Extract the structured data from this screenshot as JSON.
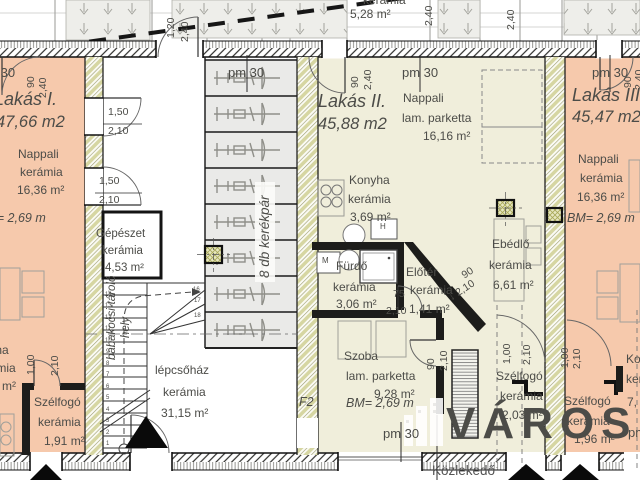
{
  "watermark": {
    "text": "VÁROSI"
  },
  "colors": {
    "apartment_warm": "#f6c9ac",
    "apartment_cool": "#f0eedb",
    "bike_area": "#eaeae8",
    "wall_hatch": "#d6d6a2"
  },
  "floor_marks": {
    "pm30": "pm 30"
  },
  "top_strip": {
    "terrace_material": "kerámia",
    "terrace_area": "5,28 m²"
  },
  "corridor_label": "Közlekedő",
  "stairwell": {
    "room": "lépcsőház",
    "material": "kerámia",
    "area": "31,15 m²",
    "stroller": "babakocsi-tároló",
    "stroller2": "hely",
    "bikes": "8 db kerékpár",
    "opening_label": "F2",
    "numbers": [
      "1",
      "2",
      "3",
      "4",
      "5",
      "6",
      "7",
      "8",
      "9",
      "10",
      "11",
      "12",
      "13",
      "14"
    ],
    "winders": [
      "16",
      "17",
      "18"
    ]
  },
  "mechanical": {
    "room": "Gépészet",
    "material": "kerámia",
    "area": "4,53 m²"
  },
  "apartments": [
    {
      "name": "Lakás I.",
      "area": "47,66 m2",
      "bm": "BM= 2,69 m",
      "nappali": {
        "room": "Nappali",
        "material": "kerámia",
        "area": "16,36 m²"
      },
      "konyha": {
        "room": "Konyha",
        "material": "kerámia",
        "area": "m²"
      },
      "szelfogo": {
        "room": "Szélfogó",
        "material": "kerámia",
        "area": "1,91 m²"
      }
    },
    {
      "name": "Lakás II.",
      "area": "45,88 m2",
      "bm": "BM= 2,69 m",
      "nappali": {
        "room": "Nappali",
        "material": "lam. parketta",
        "area": "16,16 m²"
      },
      "konyha": {
        "room": "Konyha",
        "material": "kerámia",
        "area": "3,69 m²"
      },
      "furdo": {
        "room": "Fürdő",
        "material": "kerámia",
        "area": "3,06 m²"
      },
      "eloter": {
        "room": "Előtér",
        "material": "kerámia",
        "area": "1,41 m²"
      },
      "ebedlo": {
        "room": "Ebédlő",
        "material": "kerámia",
        "area": "6,61 m²"
      },
      "szoba": {
        "room": "Szoba",
        "material": "lam. parketta",
        "area": "9,28 m²"
      },
      "szelfogo": {
        "room": "Szélfogó",
        "material": "kerámia",
        "area": "2,03 m²"
      }
    },
    {
      "name": "Lakás III.",
      "area": "45,47 m2",
      "bm": "BM= 2,69 m",
      "nappali": {
        "room": "Nappali",
        "material": "kerámia",
        "area": "16,36 m²"
      },
      "konyha": {
        "room": "Konyha",
        "material": "kerámia",
        "area": "7,"
      },
      "szelfogo": {
        "room": "Szélfogó",
        "material": "kerámia",
        "area": "1,96 m²"
      }
    }
  ],
  "appliances": {
    "washing_machine": "M",
    "fridge": "H"
  },
  "dimensions": {
    "top_left": [
      "90",
      "2,40"
    ],
    "entry_door": [
      "1,20",
      "2,40"
    ],
    "top_mid": "2,40",
    "top_right": "2,40",
    "stair_door_a": [
      "1,50",
      "2,10"
    ],
    "stair_door_b": [
      "1,50",
      "2,10"
    ],
    "lakas2_door": [
      "90",
      "2,40"
    ],
    "lakas3_door": [
      "90",
      "2,40"
    ],
    "bath_door": [
      "75",
      "2,10"
    ],
    "eloter_door": [
      "90",
      "↓ 2,10"
    ],
    "szoba_door": [
      "90",
      "2,10"
    ],
    "szelfogo1_door": [
      "1,00",
      "2,10"
    ],
    "szelfogo2_door": [
      "1,00",
      "2,10"
    ],
    "szelfogo3_door": [
      "1,00",
      "2,10"
    ]
  }
}
